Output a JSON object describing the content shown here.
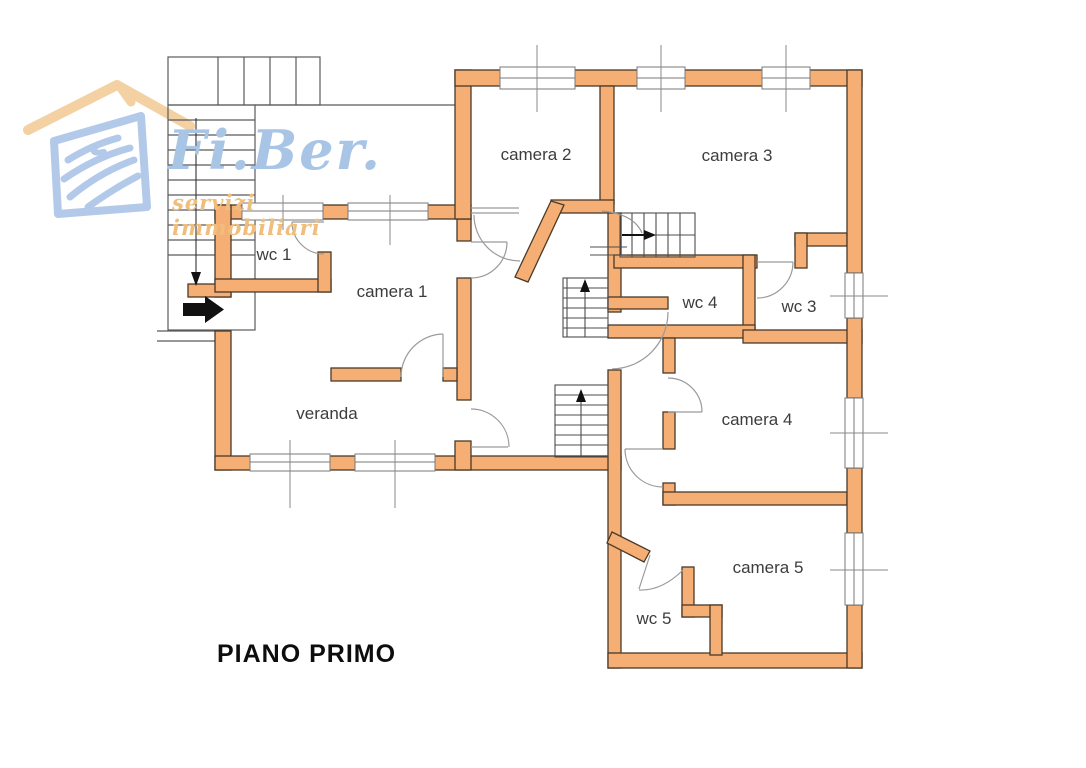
{
  "floor_plan": {
    "title": "PIANO PRIMO",
    "rooms": [
      {
        "id": "camera-2",
        "label": "camera 2"
      },
      {
        "id": "camera-3",
        "label": "camera 3"
      },
      {
        "id": "wc-1",
        "label": "wc 1"
      },
      {
        "id": "camera-1",
        "label": "camera 1"
      },
      {
        "id": "wc-4",
        "label": "wc 4"
      },
      {
        "id": "wc-3",
        "label": "wc 3"
      },
      {
        "id": "veranda",
        "label": "veranda"
      },
      {
        "id": "camera-4",
        "label": "camera 4"
      },
      {
        "id": "camera-5",
        "label": "camera 5"
      },
      {
        "id": "wc-5",
        "label": "wc 5"
      }
    ],
    "annotations": {
      "entrance_arrow": "entrance-arrow",
      "stair_arrows": [
        "stair-down-arrow",
        "stair-up-arrow-1",
        "stair-up-arrow-2",
        "stair-right-arrow"
      ]
    }
  },
  "logo": {
    "name": "Fi.Ber.",
    "tagline": "servizi immobiliari"
  },
  "colors": {
    "wall_fill": "#f5ae73",
    "wall_stroke": "#4a3a28",
    "thin_line": "#6e6e6e",
    "door_arc": "#9a9a9a",
    "logo_blue": "#afc7e8",
    "logo_roof": "#f3cf9e",
    "label_text": "#3d3d3d",
    "title_text": "#0d0d0d",
    "arrow_black": "#111111"
  }
}
